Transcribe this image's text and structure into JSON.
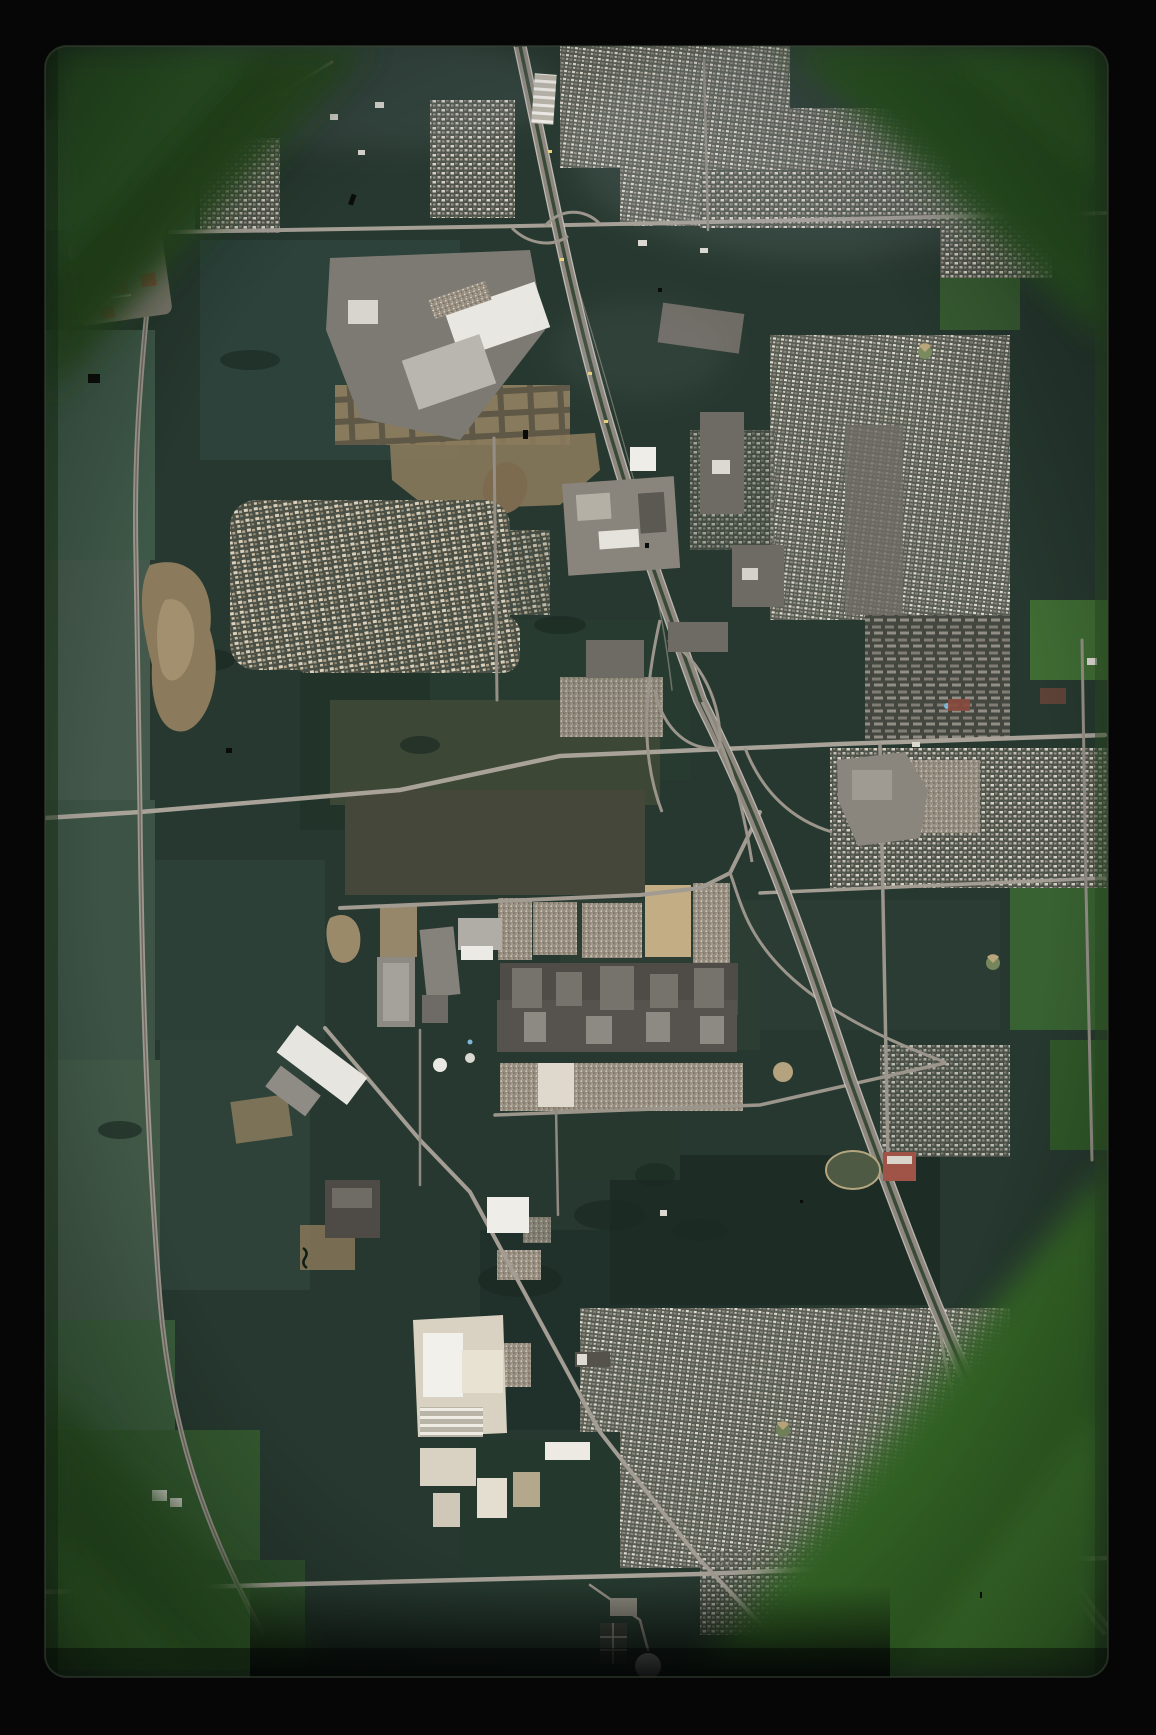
{
  "image": {
    "kind": "aerial-photograph-slide-scan",
    "description": "Vertical aerial photo on color slide film: dark green farm fields, a diagonal multi-lane freeway with interchanges, a curving beltline road on the left, a large auto-assembly plant with car-filled parking lots at center, dense residential grids on the right, a looping cul-de-sac subdivision at upper left, red-roofed apartment blocks, dirt construction sites, and a water-treatment dome at bottom. Green unexposed film shows in the rounded corners inside a black mount."
  },
  "colors": {
    "frame_black": "#060606",
    "film_green": "#2c5226",
    "film_green_bright": "#3f7a2e",
    "ground": "#26382f",
    "field_sage": "#415847",
    "field_dark": "#20302a",
    "road_light": "#a59f96",
    "freeway_pavement": "#8e8880",
    "freeway_median": "#3a4a38",
    "building_white": "#eceae4",
    "building_gray": "#6e6b64",
    "factory_dark": "#4f4c47",
    "dirt_tan": "#8b7a5c",
    "red_roof": "#9b5044",
    "pool_blue": "#7fb6d6"
  },
  "features": {
    "freeway": "diagonal-freeway",
    "beltline": "curving-beltline-road",
    "auto_plant": "auto-plant-with-parking-lots",
    "curvy_subdivision": "cul-de-sac-subdivision",
    "red_apartments": "red-roof-apartment-cluster",
    "school": "school-with-running-track",
    "water_plant": "water-treatment-dome",
    "construction": "graded-dirt-construction-site",
    "film_edge": "green-film-border",
    "mount": "black-slide-mount"
  }
}
